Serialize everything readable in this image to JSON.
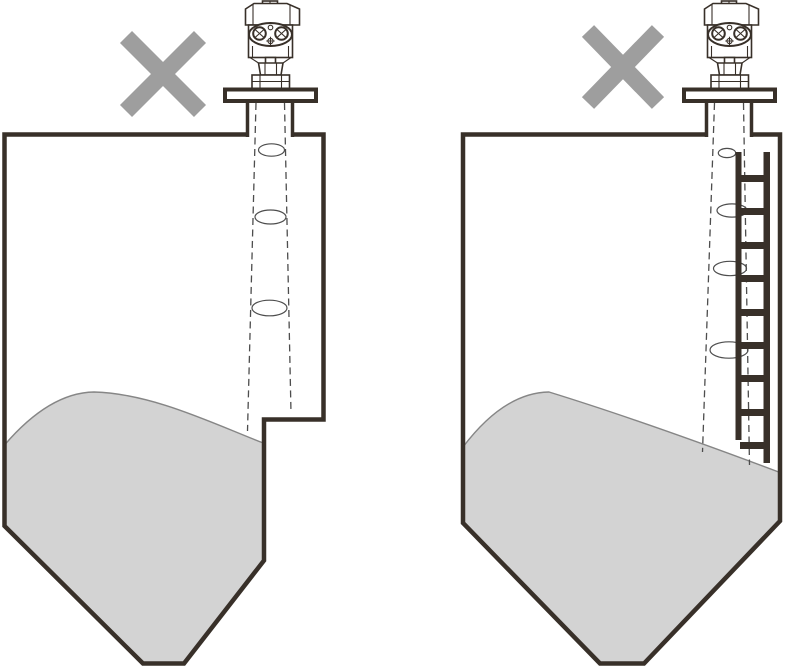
{
  "figure": {
    "type": "technical-diagram",
    "subject": "radar-level-sensor-incorrect-installation",
    "panels": [
      {
        "id": "left",
        "marker_icon": "incorrect-cross-icon",
        "obstruction": "stepped-tank-wall"
      },
      {
        "id": "right",
        "marker_icon": "incorrect-cross-icon",
        "obstruction": "ladder"
      }
    ]
  },
  "colors": {
    "background": "#ffffff",
    "line": "#383029",
    "cross": "#9e9e9e",
    "material": "#d3d3d3",
    "material_edge": "#868686",
    "beam": "#4d4d4d"
  }
}
